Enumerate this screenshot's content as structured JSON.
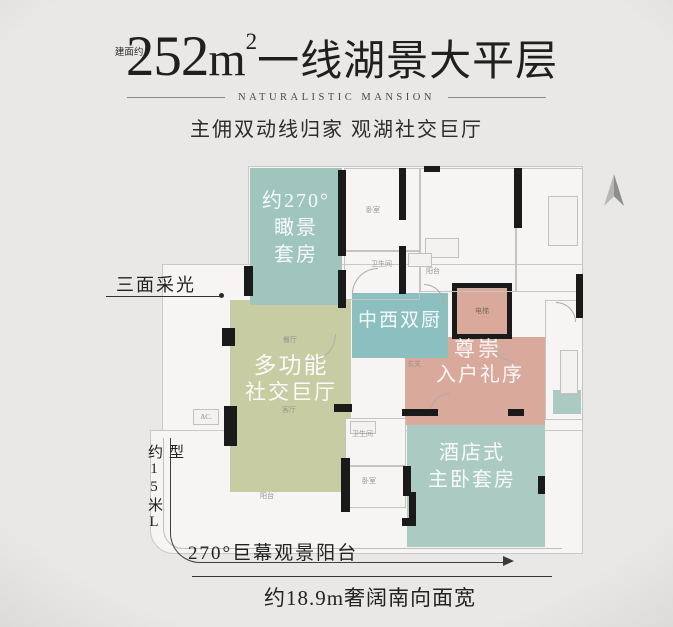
{
  "header": {
    "area_prefix": "建面约",
    "title_num": "252",
    "unit_base": "m",
    "unit_sup": "2",
    "title_rest": "一线湖景大平层",
    "subtitle": "NATURALISTIC MANSION",
    "tagline": "主佣双动线归家 观湖社交巨厅"
  },
  "plan": {
    "suite": {
      "line1": "约270°",
      "line2": "瞰景",
      "line3": "套房"
    },
    "kitchen": "中西双厨",
    "hall": {
      "line1": "多功能",
      "line2": "社交巨厅"
    },
    "entry": {
      "line1": "尊崇",
      "line2": "入户礼序"
    },
    "master": {
      "line1": "酒店式",
      "line2": "主卧套房"
    },
    "labels": {
      "bedroom_top": "卧室",
      "bath_top": "卫生间",
      "balcony_top": "阳台",
      "elevator": "电梯",
      "foyer": "玄关",
      "dining": "餐厅",
      "living": "客厅",
      "bath_lower": "卫生间",
      "bedroom_lower": "卧室",
      "balcony_lower": "阳台",
      "ac": "AC."
    }
  },
  "annotations": {
    "daylight": "三面采光",
    "side_dim": "约15米L型",
    "balcony_note": "270°巨幕观景阳台",
    "south_width": "约18.9m奢阔南向面宽"
  },
  "colors": {
    "suite_teal": "#9fc5bd",
    "kitchen_teal": "#8cbfbf",
    "master_teal": "#aacac2",
    "hall_olive": "#c7cca3",
    "entry_pink": "#d9a99c",
    "wall_black": "#1a1a1a"
  }
}
